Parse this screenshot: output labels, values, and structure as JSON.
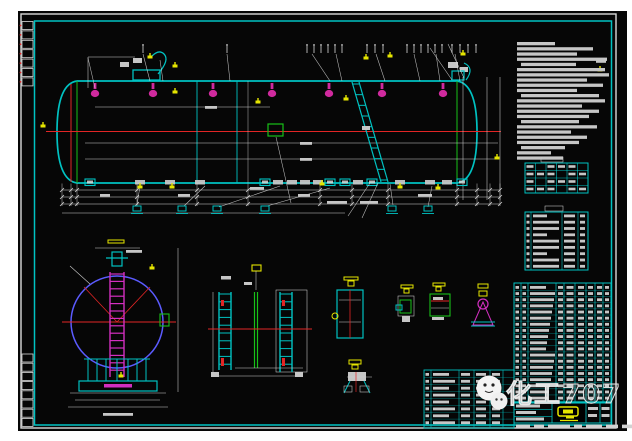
{
  "watermark": {
    "text": "化工707"
  },
  "colors": {
    "page": "#ffffff",
    "sheet": "#060606",
    "frame_white": "#d9d9d9",
    "frame_cyan": "#00c2c2",
    "cad_white": "#d9d9d9",
    "text_bar_gray": "#c6c6c6",
    "centerline_red": "#e22525",
    "nozzle_magenta": "#d02a9e",
    "ladder_magenta": "#d32fc0",
    "label_yellow": "#e5e500",
    "detail_green": "#18c018",
    "endview_blue": "#5b5bff"
  },
  "frame": {
    "rev_boxes_top": 7,
    "rev_boxes_bottom": 8
  },
  "elevation": {
    "top_nozzles_x": [
      95,
      153,
      213,
      272,
      329,
      382,
      443
    ],
    "top_ticks_x": [
      143,
      227,
      307,
      314,
      321,
      328,
      335,
      342,
      367,
      375,
      383,
      407,
      414,
      421,
      428,
      435,
      442,
      452,
      460,
      468,
      476
    ],
    "seams_x": [
      197,
      237
    ],
    "ext_lines_x": [
      62,
      71,
      77,
      137,
      197,
      248,
      320,
      352,
      388,
      457,
      477,
      490,
      500
    ],
    "dim_rows_y": [
      190,
      197,
      204
    ],
    "bottom_fittings": [
      {
        "x": 90,
        "c": "cyan"
      },
      {
        "x": 140,
        "c": "white"
      },
      {
        "x": 170,
        "c": "white"
      },
      {
        "x": 200,
        "c": "white"
      },
      {
        "x": 265,
        "c": "cyan"
      },
      {
        "x": 278,
        "c": "white"
      },
      {
        "x": 292,
        "c": "white"
      },
      {
        "x": 305,
        "c": "white"
      },
      {
        "x": 318,
        "c": "white"
      },
      {
        "x": 330,
        "c": "cyan"
      },
      {
        "x": 345,
        "c": "cyan"
      },
      {
        "x": 358,
        "c": "white"
      },
      {
        "x": 372,
        "c": "cyan"
      },
      {
        "x": 400,
        "c": "white"
      },
      {
        "x": 430,
        "c": "white"
      },
      {
        "x": 447,
        "c": "white"
      },
      {
        "x": 462,
        "c": "cyan"
      }
    ],
    "leader_labels_x": [
      137,
      182,
      217,
      265,
      392,
      428
    ],
    "yellow_marks": [
      [
        43,
        126
      ],
      [
        175,
        66
      ],
      [
        175,
        92
      ],
      [
        258,
        102
      ],
      [
        322,
        184
      ],
      [
        346,
        99
      ],
      [
        366,
        58
      ],
      [
        390,
        56
      ],
      [
        438,
        188
      ],
      [
        463,
        54
      ],
      [
        497,
        158
      ],
      [
        140,
        187
      ],
      [
        172,
        187
      ],
      [
        400,
        187
      ],
      [
        600,
        70
      ],
      [
        150,
        57
      ],
      [
        121,
        376
      ],
      [
        152,
        268
      ]
    ],
    "leaders": [
      [
        140,
        186,
        137,
        205
      ],
      [
        205,
        186,
        184,
        206
      ],
      [
        280,
        186,
        219,
        207
      ],
      [
        330,
        188,
        267,
        206
      ],
      [
        390,
        184,
        393,
        205
      ],
      [
        432,
        186,
        428,
        207
      ],
      [
        452,
        80,
        430,
        48
      ],
      [
        464,
        78,
        448,
        44
      ],
      [
        370,
        183,
        348,
        216
      ],
      [
        378,
        183,
        362,
        218
      ],
      [
        276,
        137,
        291,
        203
      ],
      [
        95,
        88,
        88,
        58
      ],
      [
        150,
        81,
        143,
        54
      ],
      [
        230,
        81,
        227,
        54
      ],
      [
        330,
        81,
        312,
        54
      ],
      [
        342,
        81,
        336,
        54
      ],
      [
        385,
        81,
        376,
        54
      ],
      [
        420,
        81,
        414,
        54
      ],
      [
        440,
        81,
        436,
        54
      ],
      [
        460,
        81,
        455,
        54
      ],
      [
        163,
        81,
        160,
        60
      ]
    ],
    "text_bars": [
      [
        250,
        187,
        14
      ],
      [
        327,
        201,
        20
      ],
      [
        360,
        201,
        18
      ],
      [
        298,
        194,
        12
      ],
      [
        418,
        194,
        14
      ],
      [
        178,
        194,
        12
      ],
      [
        100,
        194,
        10
      ],
      [
        205,
        106,
        12
      ],
      [
        300,
        142,
        12
      ],
      [
        300,
        158,
        12
      ],
      [
        596,
        60,
        10
      ],
      [
        126,
        250,
        16
      ],
      [
        103,
        413,
        30
      ]
    ]
  },
  "end_view": {
    "ladder_rungs": 14,
    "saddle_ribs_x": [
      88,
      97,
      106,
      117,
      128,
      137,
      146
    ]
  },
  "ladder_detail": {
    "rungs": 10
  },
  "notes_lines": [
    [
      0,
      38
    ],
    [
      0,
      76
    ],
    [
      0,
      60
    ],
    [
      0,
      90
    ],
    [
      4,
      55
    ],
    [
      0,
      88
    ],
    [
      0,
      92
    ],
    [
      0,
      70
    ],
    [
      0,
      86
    ],
    [
      0,
      60
    ],
    [
      4,
      78
    ],
    [
      0,
      88
    ],
    [
      0,
      65
    ],
    [
      0,
      82
    ],
    [
      0,
      72
    ],
    [
      4,
      58
    ],
    [
      0,
      80
    ],
    [
      0,
      54
    ],
    [
      0,
      70
    ],
    [
      0,
      62
    ],
    [
      4,
      44
    ],
    [
      0,
      34
    ],
    [
      0,
      46
    ]
  ],
  "tables": {
    "t1": {
      "rows": 4,
      "cols": 6
    },
    "t2": {
      "rows": 9
    },
    "bom_rows": 19,
    "annex_rows": 8,
    "bottom_row_widths": [
      14,
      10,
      22,
      8,
      16,
      12,
      18
    ]
  }
}
